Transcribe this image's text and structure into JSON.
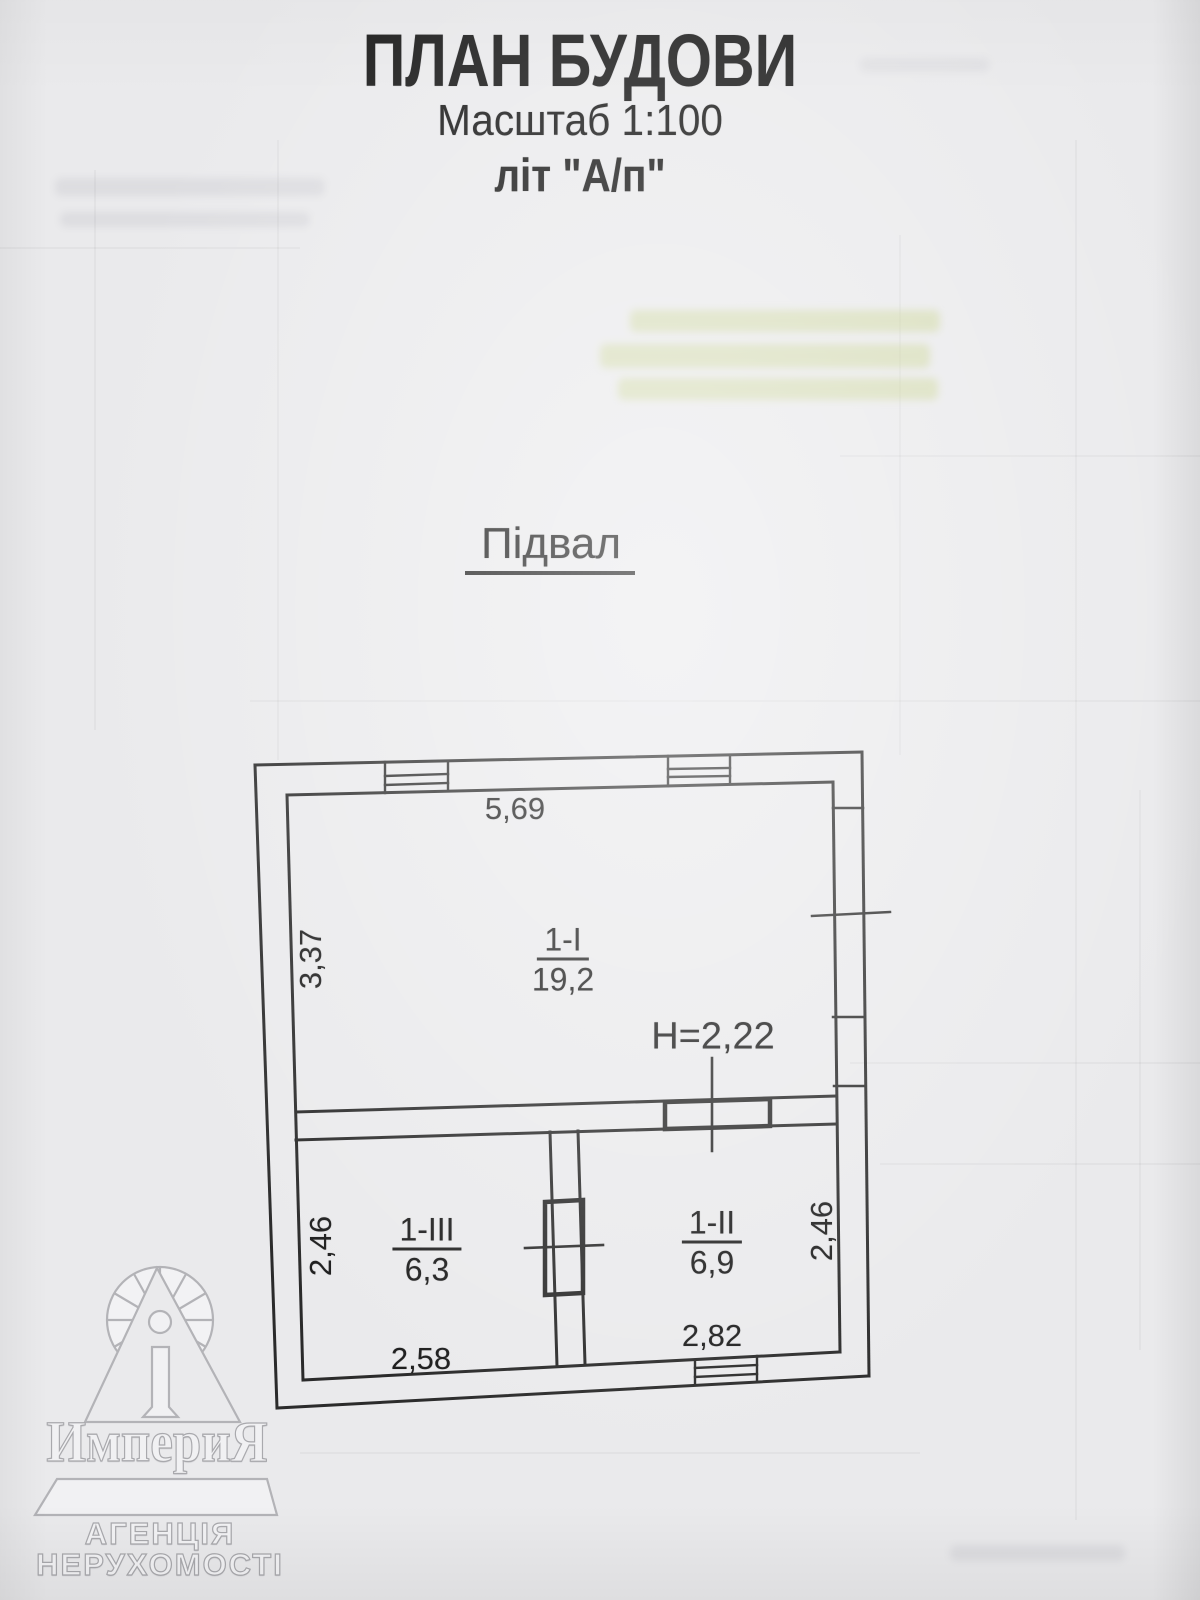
{
  "document": {
    "title": "ПЛАН БУДОВИ",
    "scale": "Масштаб 1:100",
    "letter": "літ \"А/п\"",
    "floor_label": "Підвал"
  },
  "plan": {
    "height_note": "Н=2,22",
    "dimensions": {
      "top": "5,69",
      "left_upper": "3,37",
      "left_lower": "2,46",
      "right_lower": "2,46",
      "bottom_left": "2,58",
      "bottom_right": "2,82"
    },
    "rooms": [
      {
        "number": "1-I",
        "area": "19,2"
      },
      {
        "number": "1-II",
        "area": "6,9"
      },
      {
        "number": "1-III",
        "area": "6,3"
      }
    ]
  },
  "watermark": {
    "brand": "ИмпериЯ",
    "subtitle_line1": "АГЕНЦІЯ",
    "subtitle_line2": "НЕРУХОМОСТІ"
  },
  "colors": {
    "paper": "#eaeaec",
    "ink": "#1b1b1b",
    "watermark_outline": "#a9a9ad",
    "bleed_highlight": "#c2cf7d"
  }
}
